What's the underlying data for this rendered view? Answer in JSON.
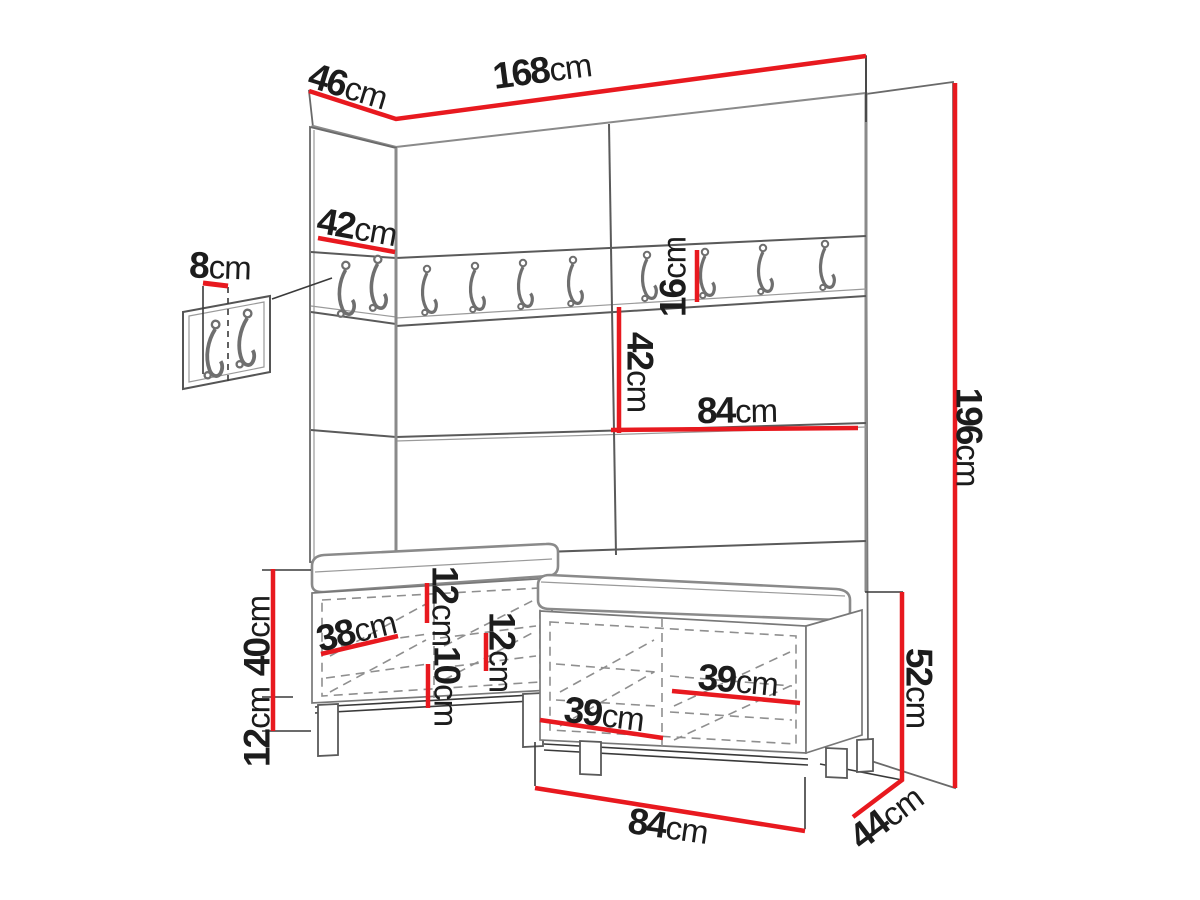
{
  "title": "Hallway furniture set dimension diagram",
  "unit": "cm",
  "colors": {
    "dimension_red": "#e8191f",
    "text": "#1c1c1c",
    "outline": "#5a5a5a",
    "outline_heavy": "#8a8a8a",
    "background": "#ffffff"
  },
  "labels": {
    "top_width": {
      "num": "168",
      "unit": "cm"
    },
    "top_depth": {
      "num": "46",
      "unit": "cm"
    },
    "total_height": {
      "num": "196",
      "unit": "cm"
    },
    "side_panel_width": {
      "num": "42",
      "unit": "cm"
    },
    "wall_hook_depth": {
      "num": "8",
      "unit": "cm"
    },
    "hook_rail_height": {
      "num": "16",
      "unit": "cm"
    },
    "panel_section_height": {
      "num": "42",
      "unit": "cm"
    },
    "panel_half_width": {
      "num": "84",
      "unit": "cm"
    },
    "cabinet_body_height": {
      "num": "40",
      "unit": "cm"
    },
    "cabinet_leg_height": {
      "num": "12",
      "unit": "cm"
    },
    "door_width": {
      "num": "38",
      "unit": "cm"
    },
    "seat_cushion_height": {
      "num": "12",
      "unit": "cm"
    },
    "seat_gap_height": {
      "num": "10",
      "unit": "cm"
    },
    "inner_shelf_height": {
      "num": "12",
      "unit": "cm"
    },
    "right_compartment_width": {
      "num": "39",
      "unit": "cm"
    },
    "left_compartment_width": {
      "num": "39",
      "unit": "cm"
    },
    "bench_total_height": {
      "num": "52",
      "unit": "cm"
    },
    "bench_width": {
      "num": "84",
      "unit": "cm"
    },
    "bench_depth": {
      "num": "44",
      "unit": "cm"
    }
  }
}
